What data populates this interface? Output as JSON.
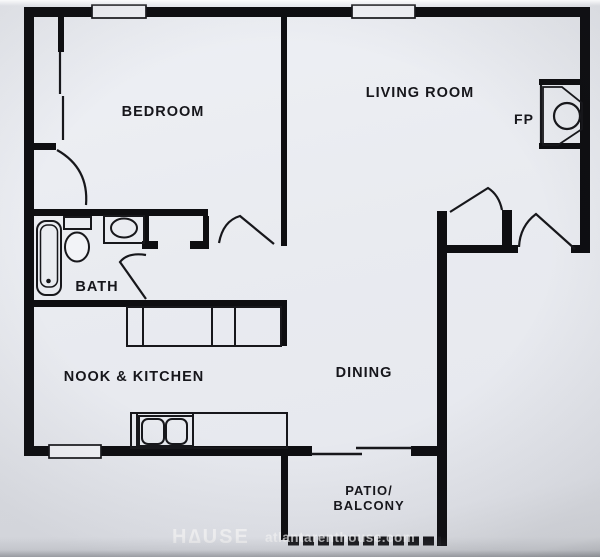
{
  "meta": {
    "type": "apartment-floor-plan"
  },
  "colors": {
    "paper": "#e9ebf0",
    "wall": "#0e0e11",
    "line": "#17171b",
    "label": "#16161b",
    "watermark": "#ffffff"
  },
  "rooms": {
    "bedroom": {
      "label": "BEDROOM"
    },
    "living_room": {
      "label": "LIVING ROOM"
    },
    "fireplace": {
      "label": "FP"
    },
    "bath": {
      "label": "BATH"
    },
    "nook_kitchen": {
      "label": "NOOK & KITCHEN"
    },
    "dining": {
      "label": "DINING"
    },
    "patio": {
      "label_line1": "PATIO/",
      "label_line2": "BALCONY"
    }
  },
  "watermark": {
    "brand": "H∆USE",
    "site": "atlantarenthouse.com"
  },
  "fixtures": [
    "bathtub",
    "toilet",
    "bathroom-sink",
    "kitchen-counter",
    "kitchen-double-sink",
    "fireplace",
    "closet-sliding-door",
    "patio-sliding-door",
    "windows",
    "swing-doors",
    "patio-railing"
  ]
}
